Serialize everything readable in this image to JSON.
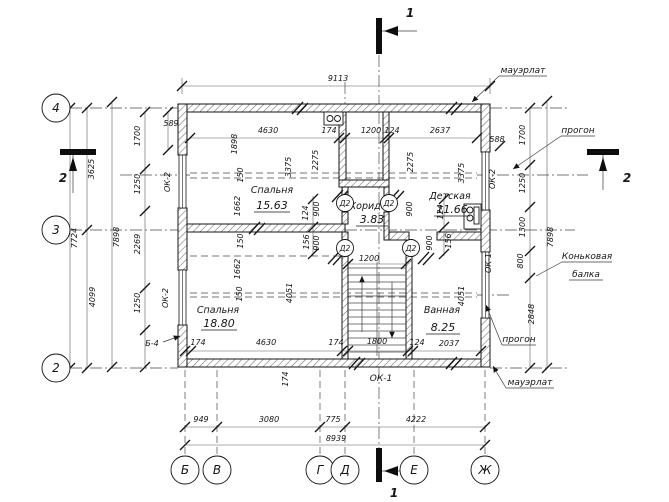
{
  "drawing": {
    "axis_marks": {
      "h": [
        "4",
        "3",
        "2"
      ],
      "v": [
        "Б",
        "В",
        "Г",
        "Д",
        "Е",
        "Ж"
      ]
    },
    "section_marks": {
      "s1": "1",
      "s2": "2"
    },
    "rooms": [
      {
        "name": "Спальня",
        "area": "15.63"
      },
      {
        "name": "Спальня",
        "area": "18.80"
      },
      {
        "name": "Детская",
        "area": "11.66"
      },
      {
        "name": "Коридор",
        "area": "3.83"
      },
      {
        "name": "Ванная",
        "area": "8.25"
      }
    ],
    "openings": {
      "door": "Д2",
      "window1": "ОК-1",
      "window2": "ОК-2",
      "beam": "Б-4"
    },
    "callouts": {
      "mauerlat": "мауэрлат",
      "purlin": "прогон",
      "ridge_line1": "Коньковая",
      "ridge_line2": "балка"
    },
    "dims": {
      "9113": "9113",
      "8939": "8939",
      "949": "949",
      "3080": "3080",
      "775": "775",
      "4222": "4222",
      "7724": "7724",
      "7898": "7898",
      "3625": "3625",
      "4099": "4099",
      "1700": "1700",
      "1250": "1250",
      "2269": "2269",
      "589": "589",
      "588": "588",
      "4630": "4630",
      "174": "174",
      "1200": "1200",
      "124": "124",
      "2637": "2637",
      "1898": "1898",
      "2275": "2275",
      "3375": "3375",
      "150": "150",
      "1662": "1662",
      "900": "900",
      "156": "156",
      "1800": "1800",
      "2037": "2037",
      "4051": "4051",
      "1300": "1300",
      "800": "800",
      "2848": "2848"
    }
  }
}
